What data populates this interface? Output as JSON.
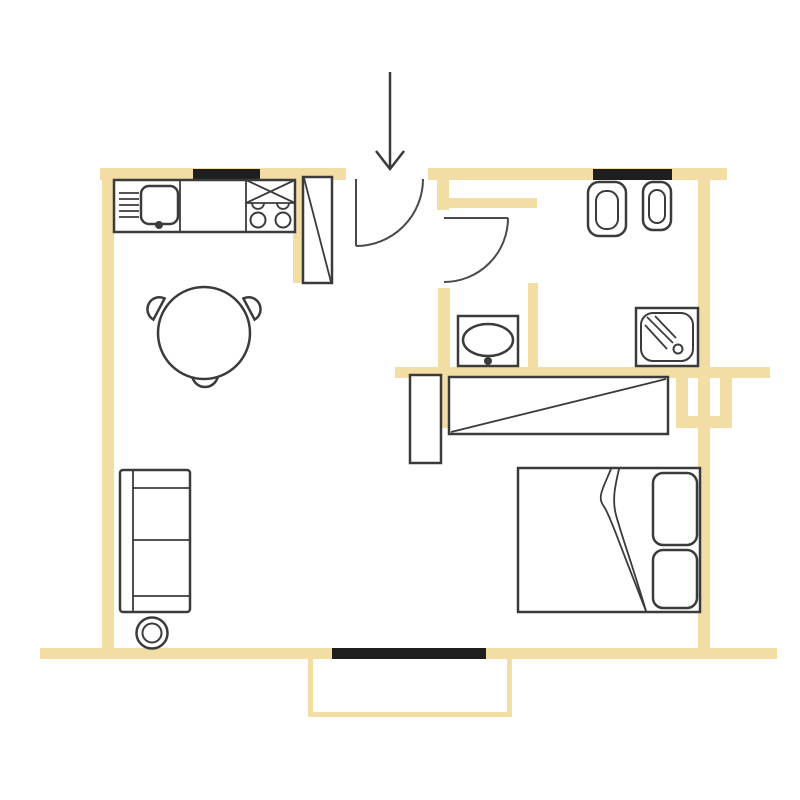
{
  "plan": {
    "kind": "apartment-floor-plan",
    "colors": {
      "wall": "#F2DDA4",
      "outline": "#3B3B3B",
      "window": "#1E1E1E",
      "door_arc": "#4A4A4A",
      "background": "#FFFFFF"
    },
    "symbols": [
      "entrance-arrow",
      "entrance-door-swing",
      "bathroom-door-swing",
      "kitchen-sink",
      "kitchen-drainboard",
      "kitchen-stove-4-burners",
      "tall-cabinet-fridge",
      "round-dining-table-3-chairs",
      "sofa-2-seat",
      "round-stool",
      "toilet",
      "bidet",
      "washbasin",
      "shower-tray",
      "wardrobe-with-diagonal",
      "small-cabinet",
      "double-bed-2-pillows",
      "duct-shaft",
      "balcony",
      "window-kitchen",
      "window-toilet",
      "window-balcony-door"
    ]
  }
}
